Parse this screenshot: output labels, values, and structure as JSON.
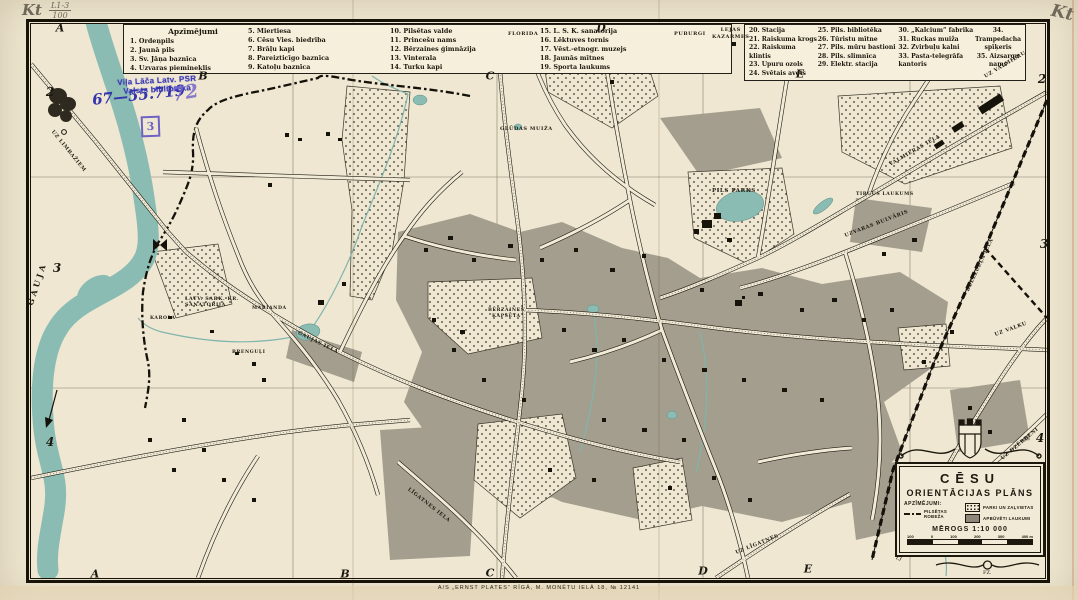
{
  "document": {
    "title": "Cēsu orientācijas plāns",
    "kind": "scanned historical city map"
  },
  "pencil_annotations": {
    "top_left_kt": "Kt",
    "top_left_fraction_numerator": "L1-3",
    "top_left_fraction_denominator": "100",
    "top_right_kt": "Kt"
  },
  "stamps": {
    "library_line1": "Viļa Lāča Latv. PSR",
    "library_line2": "Valsts bibliotēka",
    "accession_number": "67—55.719",
    "scribble": "72",
    "boxed_number": "3"
  },
  "legend_left": {
    "header": "Apzīmējumi",
    "columns": [
      [
        "1. Ordeņpils",
        "2. Jaunā pils",
        "3. Sv. Jāņa baznīca",
        "4. Uzvaras piemineklis"
      ],
      [
        "5. Miertiesa",
        "6. Cēsu Vies. biedrība",
        "7. Brāļu kapi",
        "8. Pareizticīgo baznīca",
        "9. Katoļu baznīca"
      ],
      [
        "10. Pilsētas valde",
        "11. Princešu nams",
        "12. Bērzaines ģimnāzija",
        "13. Vinterala",
        "14. Turku kapi"
      ],
      [
        "15. L. S. K. sanatorija",
        "16. Lēktuves tornis",
        "17. Vēst.-etnogr. muzejs",
        "18. Jaunās mītnes",
        "19. Sporta laukums"
      ]
    ]
  },
  "legend_right": {
    "columns": [
      [
        "20. Stacija",
        "21. Raiskuma krogs",
        "22. Raiskuma klintis",
        "23. Upuru ozols",
        "24. Svētais avots"
      ],
      [
        "25. Pils. bibliotēka",
        "26. Tūristu mītne",
        "27. Pils. mūru bastioni",
        "28. Pils. slimnīca",
        "29. Elektr. stacija"
      ],
      [
        "30. „Kalcium” fabrika",
        "31. Ruckas muiža",
        "32. Zvirbuļu kalni",
        "33. Pasta-telegrāfa\nkantoris"
      ],
      [
        "34. Trampedacha\nspīķeris",
        "35. Aizsargu nams"
      ]
    ]
  },
  "grid": {
    "columns_top": [
      "A",
      "B",
      "C",
      "D",
      "E"
    ],
    "columns_bottom": [
      "A",
      "B",
      "C",
      "D",
      "E"
    ],
    "rows_left": [
      "2",
      "3",
      "4"
    ],
    "rows_right": [
      "2",
      "3",
      "4"
    ]
  },
  "map": {
    "labels": [
      "GAUJA",
      "UZ LIMBAŽIEM",
      "FLORIDA",
      "PUBURGI",
      "LEJAS\nKAZARMES",
      "GLŪDAS MUIŽA",
      "PILS PARKS",
      "TIRGUS LAUKUMS",
      "UZVARAS BULVĀRIS",
      "VALMIERAS IELA",
      "LATV. SARK. KR.\nSANATORIJA",
      "KAROLA",
      "MARIANDA",
      "BRENGUĻI",
      "BĒRZAINES\nKAPSĒTA",
      "GAUJAS IELA",
      "LĪGATNES IELA",
      "UZ LĪGATNES",
      "UZ VALMIERU",
      "UZ VALKU",
      "UZ DZĒRBENI",
      "DZELZCEĻA IELA"
    ]
  },
  "cartouche": {
    "title_line1": "CĒSU",
    "title_line2": "ORIENTĀCIJAS PLĀNS",
    "legend_header": "APZĪMĒJUMI:",
    "boundary_label": "PILSĒTAS\nROBEŽA",
    "parks_label": "PARKI UN ZAĻVIETAS",
    "built_label": "APBŪVĒTI LAUKUMI",
    "scale_label": "MĒROGS 1:10 000",
    "scale_ticks": [
      "100",
      "0",
      "100",
      "200",
      "300",
      "400 m"
    ],
    "monogram": "FZ."
  },
  "imprint": "A/S „ERNST PLATES” RĪGĀ, M. MONĒTU IELĀ 18, № 12141",
  "colors": {
    "paper": "#efe7d1",
    "water": "#8abcb3",
    "built_up": "#a49e8f",
    "ink": "#1c180e",
    "stamp_blue": "#3b3bb6",
    "pencil_gray": "#6f6757"
  }
}
